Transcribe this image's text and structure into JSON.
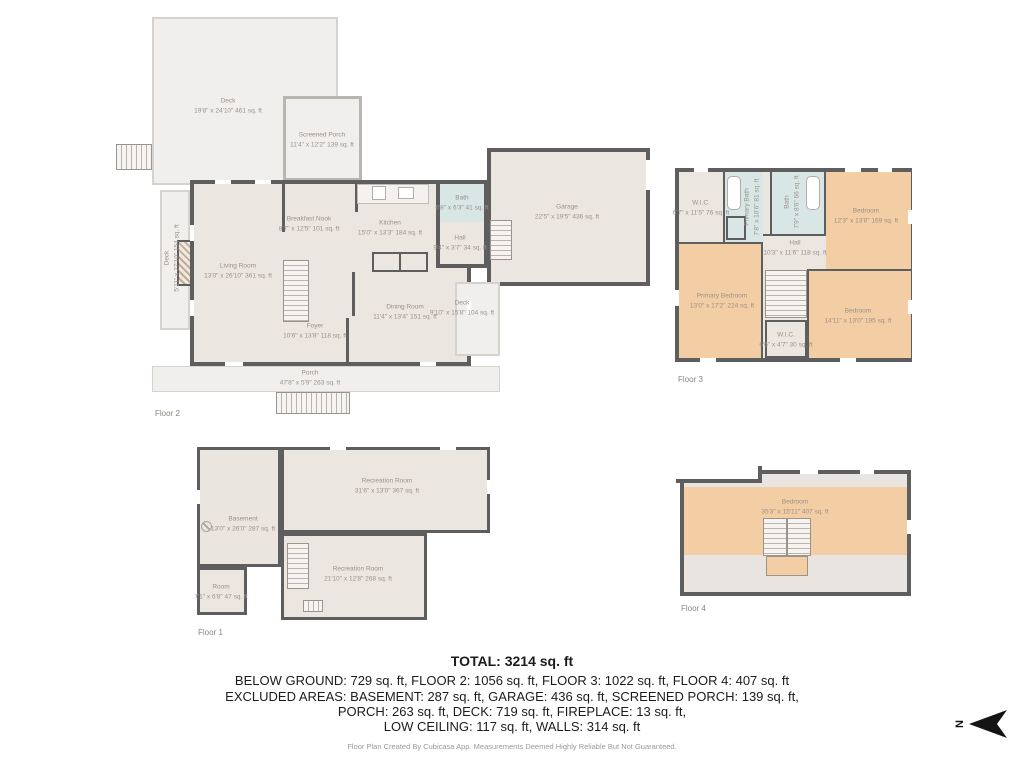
{
  "colors": {
    "wall": "#5e5e5e",
    "floor": "#ece6e0",
    "deck": "#f0efee",
    "bath_fill": "#d8e7e5",
    "bedroom_fill": "#f3cda3",
    "label_text": "#9a9189"
  },
  "floor2": {
    "label": "Floor 2",
    "rooms": {
      "deck_top": {
        "name": "Deck",
        "dims": "19'8\" x 24'10\" 461 sq. ft"
      },
      "screened_porch": {
        "name": "Screened Porch",
        "dims": "11'4\" x 12'2\" 139 sq. ft"
      },
      "breakfast_nook": {
        "name": "Breakfast Nook",
        "dims": "8'7\" x 12'5\" 101 sq. ft"
      },
      "kitchen": {
        "name": "Kitchen",
        "dims": "15'0\" x 13'3\" 184 sq. ft"
      },
      "bath": {
        "name": "Bath",
        "dims": "6'8\" x 6'3\" 41 sq. ft"
      },
      "hall": {
        "name": "Hall",
        "dims": "9'4\" x 3'7\" 34 sq. ft"
      },
      "living_room": {
        "name": "Living Room",
        "dims": "13'0\" x 26'10\" 361 sq. ft"
      },
      "dining_room": {
        "name": "Dining Room",
        "dims": "11'4\" x 13'4\" 151 sq. ft"
      },
      "foyer": {
        "name": "Foyer",
        "dims": "10'6\" x 13'8\" 118 sq. ft"
      },
      "porch": {
        "name": "Porch",
        "dims": "47'8\" x 5'9\" 263 sq. ft"
      },
      "deck_right": {
        "name": "Deck",
        "dims": "9'10\" x 15'8\" 104 sq. ft"
      },
      "deck_left": {
        "name": "Deck",
        "dims": "5'11\" x 27'10\" 154 sq. ft"
      },
      "garage": {
        "name": "Garage",
        "dims": "22'5\" x 19'5\" 436 sq. ft"
      }
    }
  },
  "floor3": {
    "label": "Floor 3",
    "rooms": {
      "wic_top": {
        "name": "W.I.C.",
        "dims": "6'7\" x 11'5\" 76 sq. ft"
      },
      "primary_bath": {
        "name": "Primary Bath",
        "dims": "7'8\" x 10'6\" 81 sq. ft"
      },
      "bath": {
        "name": "Bath",
        "dims": "7'9\" x 8'6\" 66 sq. ft"
      },
      "bedroom_top": {
        "name": "Bedroom",
        "dims": "12'3\" x 13'8\" 169 sq. ft"
      },
      "hall": {
        "name": "Hall",
        "dims": "10'3\" x 11'6\" 118 sq. ft"
      },
      "primary_bedroom": {
        "name": "Primary Bedroom",
        "dims": "13'0\" x 17'2\" 224 sq. ft"
      },
      "bedroom_bottom": {
        "name": "Bedroom",
        "dims": "14'11\" x 13'0\" 195 sq. ft"
      },
      "wic_bottom": {
        "name": "W.I.C.",
        "dims": "6'6\" x 4'7\" 30 sq. ft"
      }
    }
  },
  "floor1": {
    "label": "Floor 1",
    "rooms": {
      "rec_top": {
        "name": "Recreation Room",
        "dims": "31'6\" x 13'0\" 367 sq. ft"
      },
      "basement": {
        "name": "Basement",
        "dims": "13'0\" x 26'0\" 287 sq. ft"
      },
      "rec_bottom": {
        "name": "Recreation Room",
        "dims": "21'10\" x 12'8\" 268 sq. ft"
      },
      "room": {
        "name": "Room",
        "dims": "7'1\" x 6'8\" 47 sq. ft"
      }
    }
  },
  "floor4": {
    "label": "Floor 4",
    "rooms": {
      "bedroom": {
        "name": "Bedroom",
        "dims": "35'3\" x 15'11\" 407 sq. ft"
      }
    }
  },
  "summary": {
    "total": "TOTAL: 3214 sq. ft",
    "line1": "BELOW GROUND: 729 sq. ft, FLOOR 2: 1056 sq. ft, FLOOR 3: 1022 sq. ft, FLOOR 4: 407 sq. ft",
    "line2": "EXCLUDED AREAS: BASEMENT: 287 sq. ft, GARAGE: 436 sq. ft, SCREENED PORCH: 139 sq. ft,",
    "line3": "PORCH: 263 sq. ft, DECK: 719 sq. ft, FIREPLACE: 13 sq. ft,",
    "line4": "LOW CEILING: 117 sq. ft, WALLS: 314 sq. ft",
    "footer": "Floor Plan Created By Cubicasa App. Measurements Deemed Highly Reliable But Not Guaranteed."
  },
  "compass": {
    "label": "N"
  }
}
